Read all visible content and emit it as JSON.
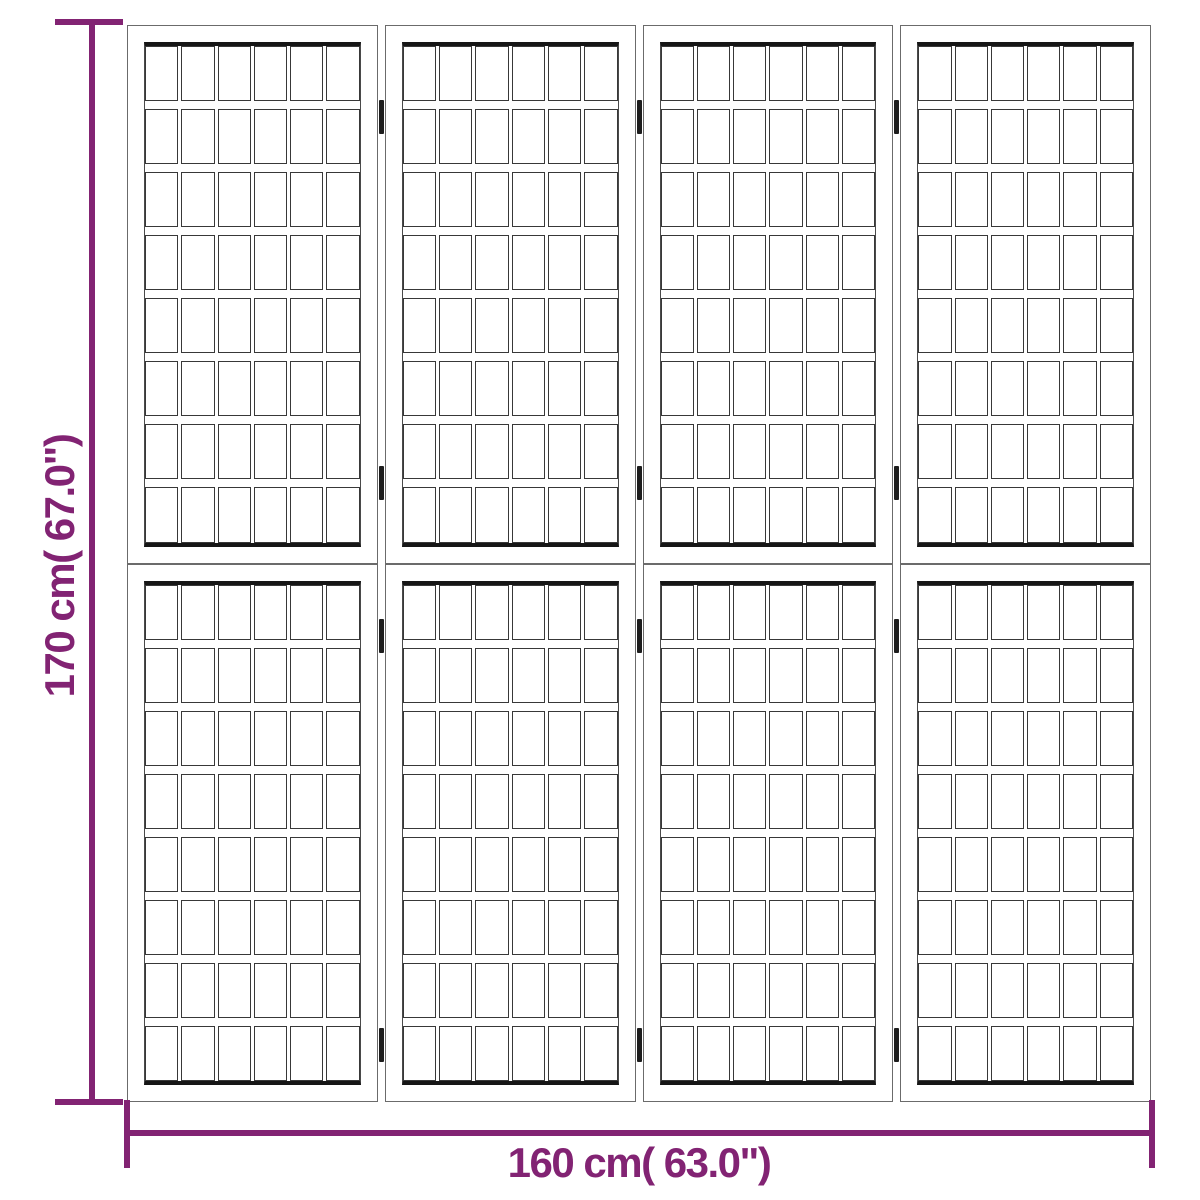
{
  "image": {
    "type": "product-dimension-diagram",
    "subject": "4-panel folding room divider with shoji-style lattice",
    "background_color": "#ffffff"
  },
  "divider": {
    "panel_count": 4,
    "sections_per_panel": 2,
    "lattice_columns": 6,
    "lattice_rows": 8,
    "hinge_joints": 3,
    "hinges_per_joint": 4,
    "hinge_y_positions": [
      100,
      466,
      619,
      1028
    ],
    "frame_color": "#6b6b6b",
    "lattice_line_color": "#383838",
    "rail_line_color": "#161616",
    "hinge_color": "#1d1d1d"
  },
  "dimensions": {
    "accent_color": "#822373",
    "height": {
      "label": "170 cm( 67.0\")"
    },
    "width": {
      "label": "160 cm( 63.0\")"
    }
  }
}
